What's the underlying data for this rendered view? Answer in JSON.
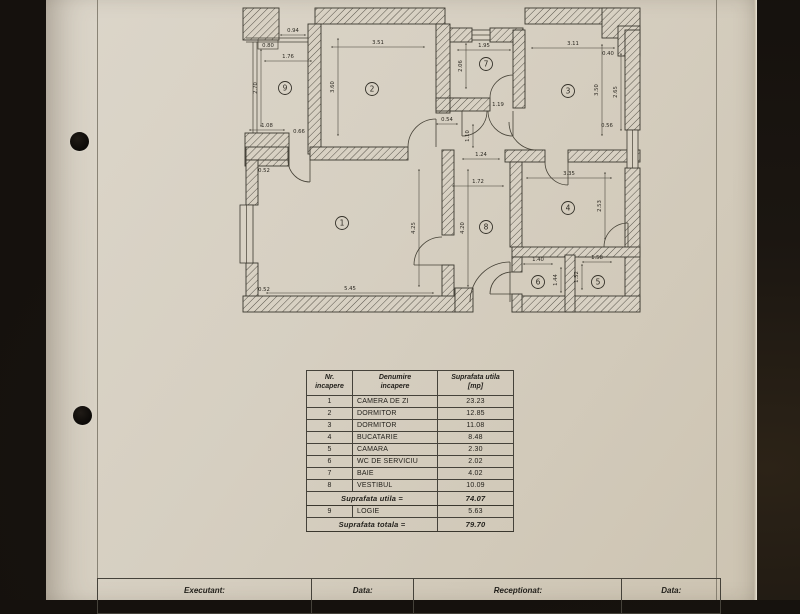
{
  "table": {
    "headers": {
      "nr_line1": "Nr.",
      "nr_line2": "incapere",
      "name_line1": "Denumire",
      "name_line2": "incapere",
      "area_line1": "Suprafata utila",
      "area_line2": "[mp]"
    },
    "rows": [
      {
        "nr": "1",
        "name": "CAMERA DE ZI",
        "area": "23.23"
      },
      {
        "nr": "2",
        "name": "DORMITOR",
        "area": "12.85"
      },
      {
        "nr": "3",
        "name": "DORMITOR",
        "area": "11.08"
      },
      {
        "nr": "4",
        "name": "BUCATARIE",
        "area": "8.48"
      },
      {
        "nr": "5",
        "name": "CAMARA",
        "area": "2.30"
      },
      {
        "nr": "6",
        "name": "WC DE SERVICIU",
        "area": "2.02"
      },
      {
        "nr": "7",
        "name": "BAIE",
        "area": "4.02"
      },
      {
        "nr": "8",
        "name": "VESTIBUL",
        "area": "10.09"
      }
    ],
    "subtotal_label": "Suprafata utila =",
    "subtotal_value": "74.07",
    "row9": {
      "nr": "9",
      "name": "LOGIE",
      "area": "5.63"
    },
    "total_label": "Suprafata totala =",
    "total_value": "79.70"
  },
  "footer": {
    "executant": "Executant:",
    "data1": "Data:",
    "receptionat": "Receptionat:",
    "data2": "Data:"
  },
  "plan": {
    "rooms": [
      {
        "n": "1",
        "x": 342,
        "y": 223
      },
      {
        "n": "2",
        "x": 372,
        "y": 89
      },
      {
        "n": "3",
        "x": 568,
        "y": 91
      },
      {
        "n": "4",
        "x": 568,
        "y": 208
      },
      {
        "n": "5",
        "x": 598,
        "y": 282
      },
      {
        "n": "6",
        "x": 538,
        "y": 282
      },
      {
        "n": "7",
        "x": 486,
        "y": 64
      },
      {
        "n": "8",
        "x": 486,
        "y": 227
      },
      {
        "n": "9",
        "x": 285,
        "y": 88
      }
    ],
    "dims": [
      {
        "t": "0.94",
        "x": 293,
        "y": 32,
        "len": 26
      },
      {
        "t": "0.80",
        "x": 268,
        "y": 47,
        "box": true
      },
      {
        "t": "1.76",
        "x": 288,
        "y": 58,
        "len": 48
      },
      {
        "t": "2.70",
        "x": 257,
        "y": 88,
        "v": true,
        "len": 78
      },
      {
        "t": "1.08",
        "x": 267,
        "y": 127,
        "len": 36
      },
      {
        "t": "0.66",
        "x": 299,
        "y": 133
      },
      {
        "t": "0.52",
        "x": 264,
        "y": 172
      },
      {
        "t": "3.51",
        "x": 378,
        "y": 44,
        "len": 94
      },
      {
        "t": "3.60",
        "x": 334,
        "y": 87,
        "v": true,
        "len": 98
      },
      {
        "t": "1.95",
        "x": 484,
        "y": 47,
        "len": 54
      },
      {
        "t": "2.06",
        "x": 462,
        "y": 66,
        "v": true,
        "len": 46
      },
      {
        "t": "1.19",
        "x": 498,
        "y": 106
      },
      {
        "t": "3.11",
        "x": 573,
        "y": 45,
        "len": 84
      },
      {
        "t": "0.40",
        "x": 608,
        "y": 55
      },
      {
        "t": "3.50",
        "x": 598,
        "y": 90,
        "v": true,
        "len": 92
      },
      {
        "t": "2.65",
        "x": 617,
        "y": 92,
        "v": true,
        "len": 78
      },
      {
        "t": "0.56",
        "x": 607,
        "y": 127
      },
      {
        "t": "0.54",
        "x": 447,
        "y": 121,
        "len": 22
      },
      {
        "t": "1.10",
        "x": 469,
        "y": 136,
        "v": true,
        "len": 24
      },
      {
        "t": "1.24",
        "x": 481,
        "y": 156,
        "len": 38
      },
      {
        "t": "1.72",
        "x": 478,
        "y": 183,
        "len": 52
      },
      {
        "t": "3.35",
        "x": 569,
        "y": 175,
        "len": 86
      },
      {
        "t": "2.53",
        "x": 601,
        "y": 206,
        "v": true,
        "len": 68
      },
      {
        "t": "4.25",
        "x": 415,
        "y": 228,
        "v": true,
        "len": 118
      },
      {
        "t": "4.20",
        "x": 464,
        "y": 228,
        "v": true,
        "len": 118
      },
      {
        "t": "5.45",
        "x": 350,
        "y": 290,
        "len": 168
      },
      {
        "t": "0.52",
        "x": 264,
        "y": 291
      },
      {
        "t": "1.40",
        "x": 538,
        "y": 261,
        "len": 30
      },
      {
        "t": "1.44",
        "x": 557,
        "y": 280,
        "v": true,
        "len": 26
      },
      {
        "t": "1.58",
        "x": 597,
        "y": 259,
        "len": 30
      },
      {
        "t": "1.52",
        "x": 578,
        "y": 277,
        "v": true,
        "len": 26
      }
    ]
  }
}
